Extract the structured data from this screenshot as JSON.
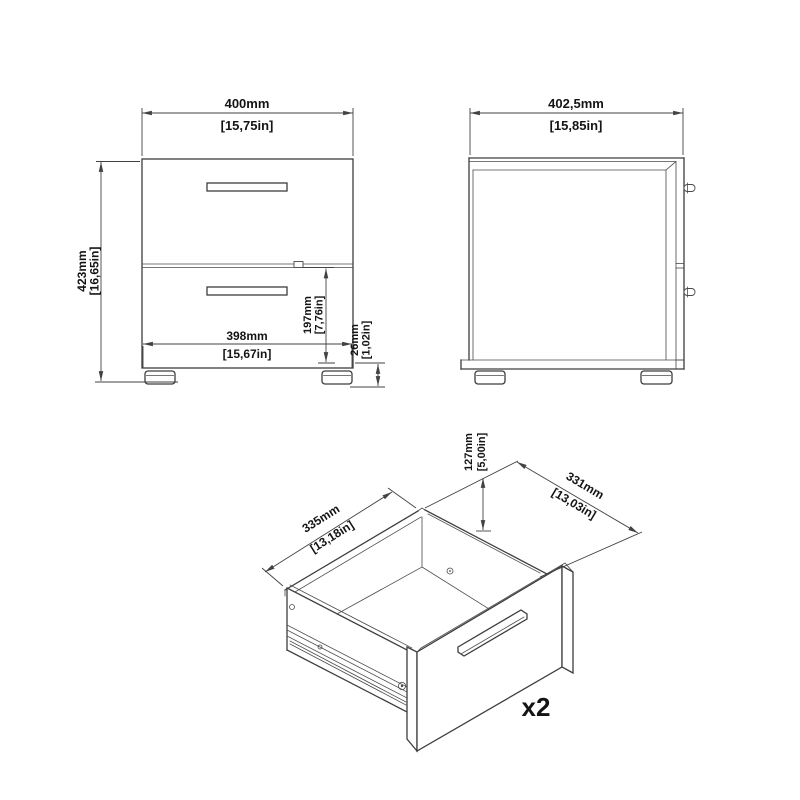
{
  "drawing": {
    "bg_color": "#ffffff",
    "line_color": "#3d3d3d",
    "dim_color": "#424242",
    "text_color": "#141414",
    "views": {
      "front": {
        "width": {
          "mm": "400mm",
          "inch": "[15,75in]"
        },
        "height": {
          "mm": "423mm",
          "inch": "[16,65in]"
        },
        "inner_width": {
          "mm": "398mm",
          "inch": "[15,67in]"
        },
        "drawer_front_height": {
          "mm": "197mm",
          "inch": "[7,76in]"
        },
        "foot_height": {
          "mm": "26mm",
          "inch": "[1,02in]"
        }
      },
      "side": {
        "depth": {
          "mm": "402,5mm",
          "inch": "[15,85in]"
        }
      },
      "drawer": {
        "depth": {
          "mm": "335mm",
          "inch": "[13,18in]"
        },
        "height": {
          "mm": "127mm",
          "inch": "[5,00in]"
        },
        "width": {
          "mm": "331mm",
          "inch": "[13,03in]"
        },
        "quantity": "x2"
      }
    }
  }
}
